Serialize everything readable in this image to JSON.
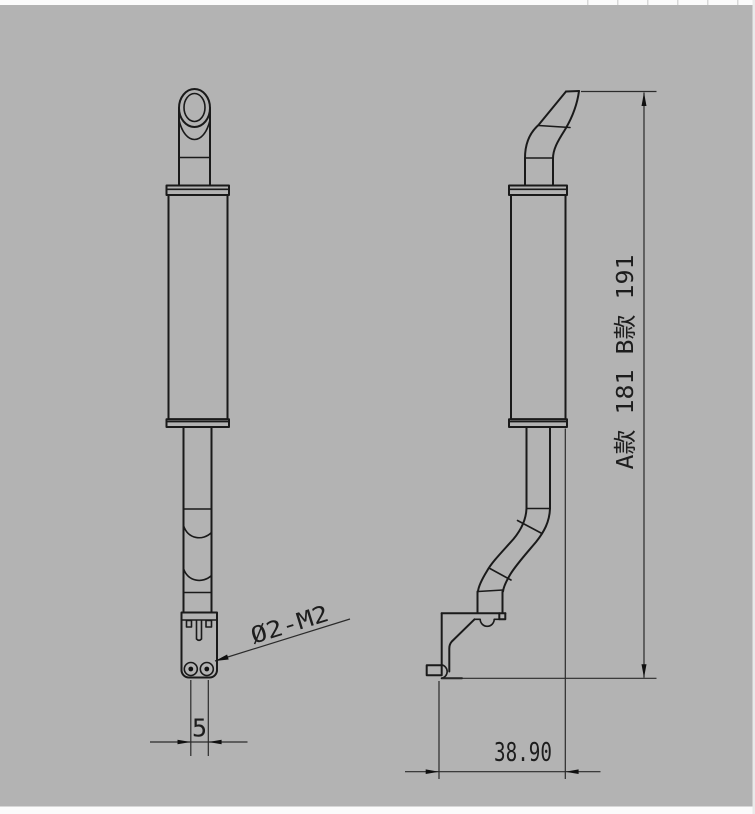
{
  "colors": {
    "background": "#b3b3b3",
    "line": "#1a1a1a",
    "dimension_line": "#2b2b2b",
    "paper_edge": "#fbfbfb"
  },
  "dimensions": {
    "hole_callout": "Ø2-M2",
    "hole_spacing": "5",
    "overall_height": "A款 181  B款 191",
    "overall_depth": "38.90"
  }
}
